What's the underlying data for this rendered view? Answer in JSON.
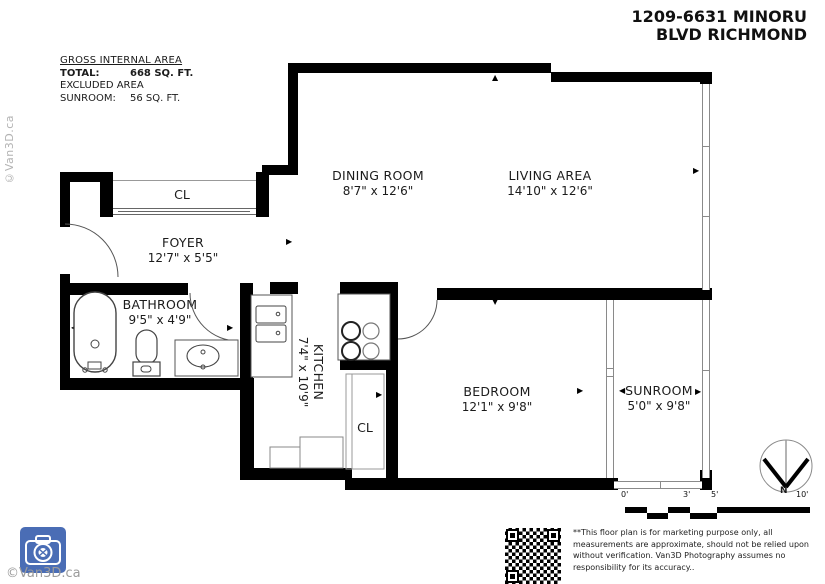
{
  "title": {
    "line1": "1209-6631 MINORU",
    "line2": "BLVD RICHMOND"
  },
  "area_summary": {
    "heading": "GROSS INTERNAL AREA",
    "total_label": "TOTAL:",
    "total_value": "668 SQ. FT.",
    "excluded_label": "EXCLUDED AREA",
    "sunroom_label": "SUNROOM:",
    "sunroom_value": "56 SQ. FT."
  },
  "rooms": {
    "dining": {
      "name": "DINING ROOM",
      "dims": "8'7\" x 12'6\""
    },
    "living": {
      "name": "LIVING AREA",
      "dims": "14'10\" x 12'6\""
    },
    "foyer": {
      "name": "FOYER",
      "dims": "12'7\" x 5'5\""
    },
    "bathroom": {
      "name": "BATHROOM",
      "dims": "9'5\" x 4'9\""
    },
    "kitchen": {
      "name": "KITCHEN",
      "dims": "7'4\" x 10'9\""
    },
    "bedroom": {
      "name": "BEDROOM",
      "dims": "12'1\" x 9'8\""
    },
    "sunroom": {
      "name": "SUNROOM",
      "dims": "5'0\" x 9'8\""
    },
    "closet_label": "CL"
  },
  "scale_bar": {
    "labels": [
      "0'",
      "3'",
      "5'",
      "10'"
    ]
  },
  "compass": {
    "north_label": "N"
  },
  "watermark": {
    "side_text": "©Van3D.ca",
    "bottom_text": "©Van3D.ca"
  },
  "disclaimer": "**This floor plan is for marketing purpose only, all measurements are approximate, should not be relied upon without verification. Van3D Photography assumes no responsibility for its accuracy..",
  "icons": {
    "arrow_up": "▲",
    "arrow_down": "▼",
    "arrow_left": "◀",
    "arrow_right": "▶"
  },
  "colors": {
    "wall": "#000000",
    "window_line": "#8a8a8a",
    "logo_blue": "#4a6db5",
    "watermark_gray": "#9b9b9b"
  }
}
